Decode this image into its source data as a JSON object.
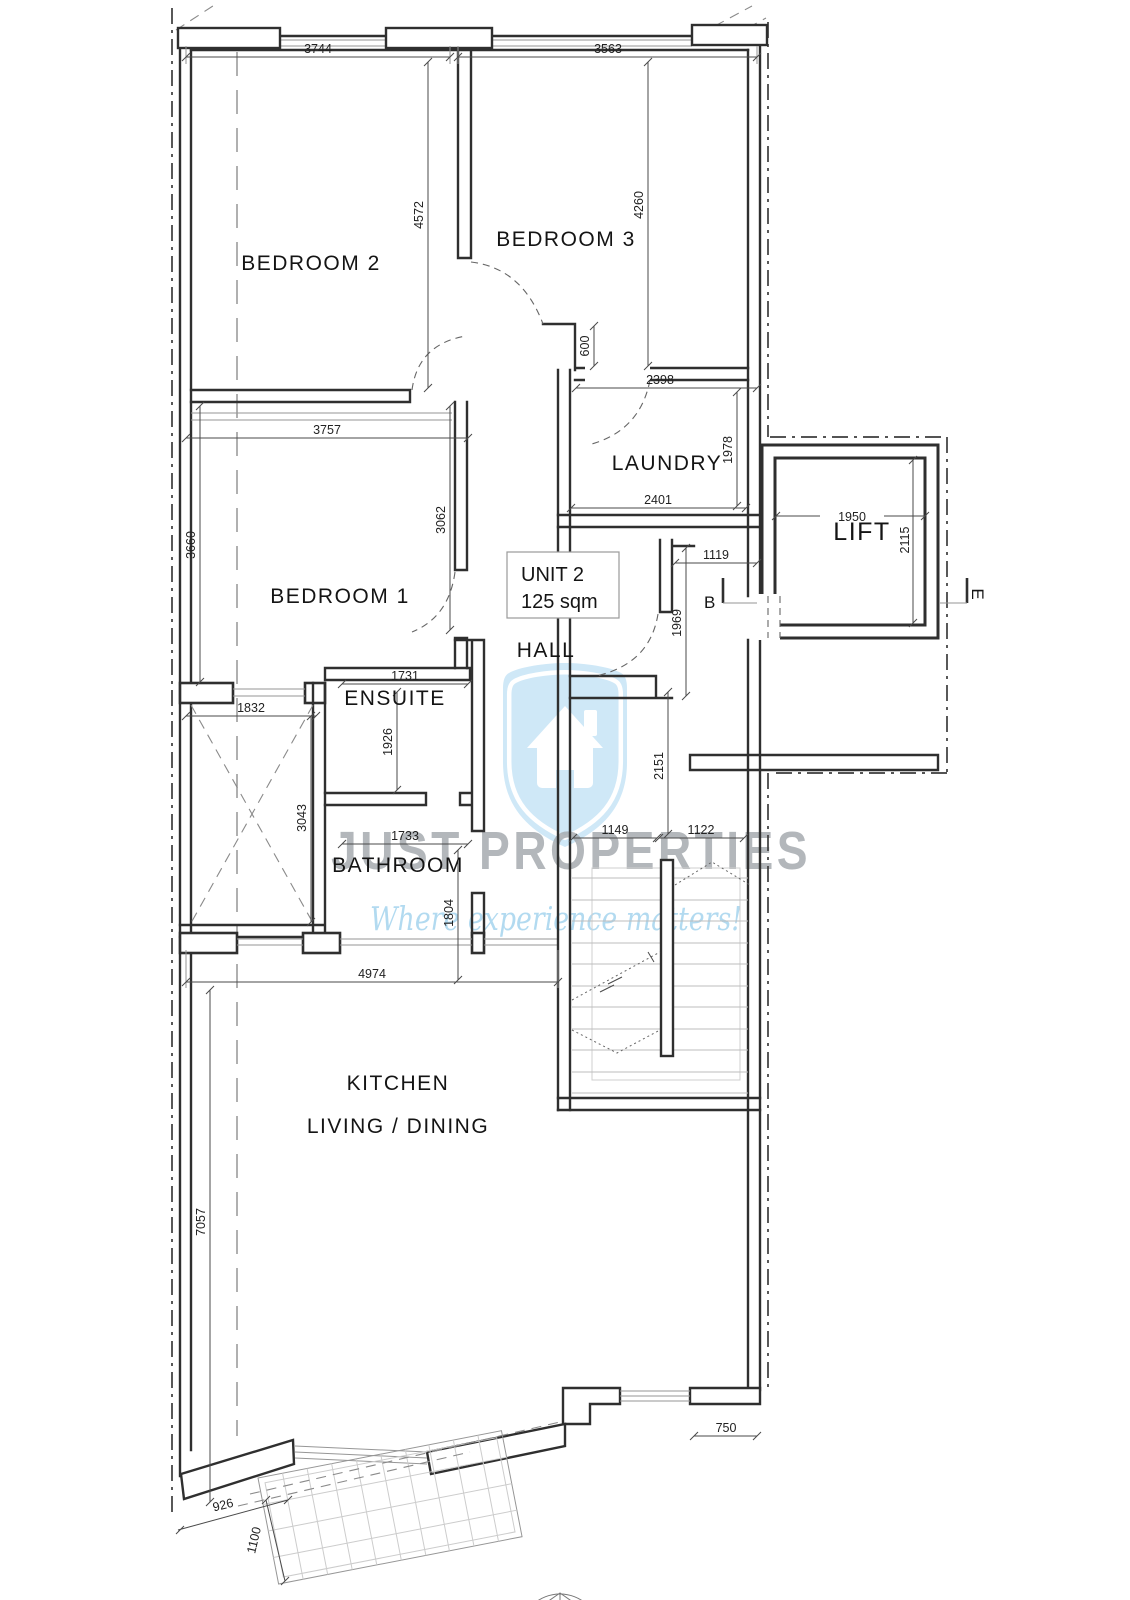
{
  "page": {
    "background": "#ffffff"
  },
  "unit_box": {
    "title": "UNIT 2",
    "area": "125 sqm"
  },
  "rooms": {
    "bedroom2": "BEDROOM 2",
    "bedroom3": "BEDROOM 3",
    "laundry": "LAUNDRY",
    "lift": "LIFT",
    "bedroom1": "BEDROOM 1",
    "ensuite": "ENSUITE",
    "bathroom": "BATHROOM",
    "hall": "HALL",
    "kitchen": "KITCHEN",
    "living": "LIVING / DINING"
  },
  "section_markers": {
    "b": "B",
    "e": "E"
  },
  "dims": {
    "bedroom2_width": "3744",
    "bedroom3_width": "3563",
    "bedroom2_length": "4572",
    "bedroom3_length": "4260",
    "niche": "600",
    "bedroom3_bottom": "2398",
    "bedroom1_width": "3757",
    "laundry_length": "1978",
    "laundry_width": "2401",
    "lift_width": "1950",
    "lift_depth": "2115",
    "lobby_width": "1119",
    "hall_length": "1969",
    "bedroom1_length": "3660",
    "bedroom1_side": "3062",
    "shaft_width": "1832",
    "ensuite_width": "1731",
    "ensuite_length": "1926",
    "shaft_length": "3043",
    "bathroom_width": "1733",
    "bathroom_length": "1804",
    "hall_void": "2151",
    "stair_left": "1149",
    "stair_right": "1122",
    "kitchen_width": "4974",
    "kitchen_length": "7057",
    "terrace_right": "750",
    "terrace_left": "926",
    "balcony_depth": "1100"
  },
  "watermark": {
    "brand": "JUST PROPERTIES",
    "tagline": "Where experience matters!"
  },
  "colors": {
    "wall": "#2f2f2f",
    "thin": "#969696",
    "dim": "#4a4a4a",
    "boundary": "#3c3c3c",
    "site": "#8f8f8f",
    "tread": "#bcbcbc",
    "grid": "#cccccc",
    "shield": "#cfe8f7",
    "brand": "#a6abb0",
    "tagline": "#aed9f0"
  }
}
